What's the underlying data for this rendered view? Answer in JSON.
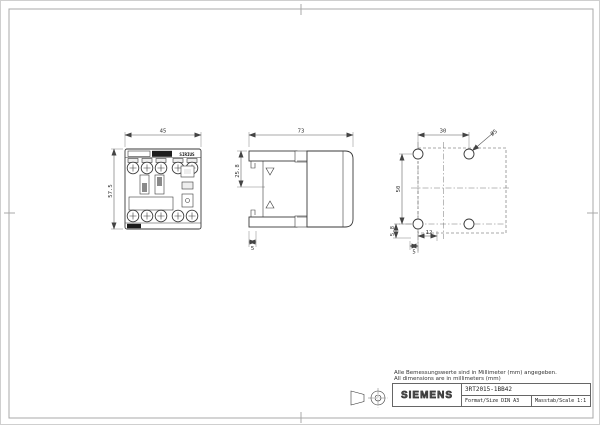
{
  "drawing": {
    "notes": {
      "de": "Alle Bemessungswerte sind in Millimeter (mm) angegeben.",
      "en": "All dimensions are in millimeters (mm)"
    },
    "title_block": {
      "brand": "SIEMENS",
      "part_number": "3RT2015-1BB42",
      "format": "Format/Size DIN A3",
      "scale": "Masstab/Scale 1:1"
    },
    "views": {
      "front": {
        "product_label": "SIRIUS",
        "dim_width": "45",
        "dim_height": "57.5"
      },
      "side": {
        "dim_depth": "73",
        "dim_clip": "25.8",
        "dim_foot": "5"
      },
      "drill": {
        "dim_hole_spacing_h": "30",
        "dim_hole_spacing_v": "50",
        "dim_hole_dia": "Ø5",
        "dim_edge": "5.8",
        "dim_bottom_h": "12",
        "dim_bottom_v": "5"
      }
    }
  }
}
